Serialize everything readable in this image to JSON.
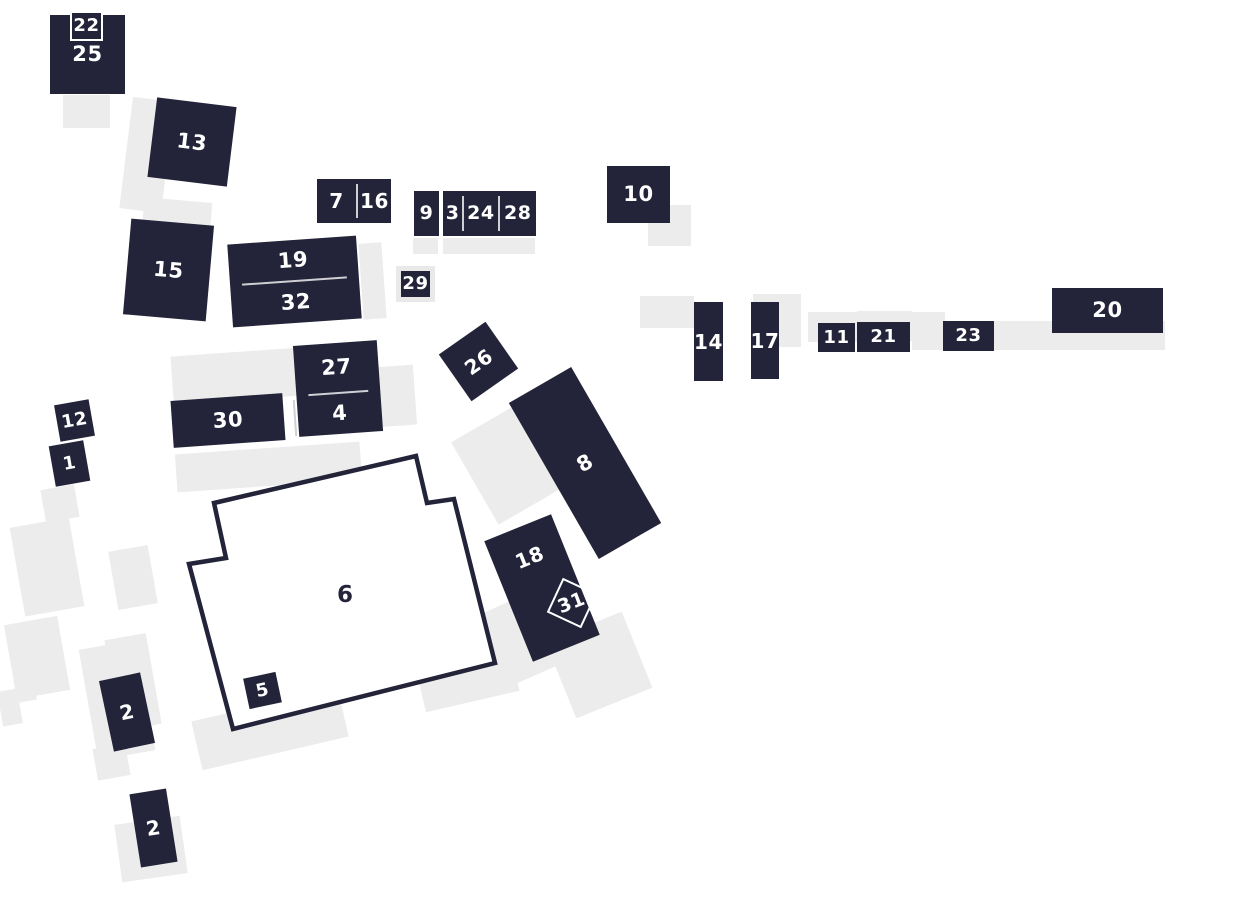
{
  "map": {
    "name": "numbered-building-site-map",
    "width": 1240,
    "height": 900
  },
  "colors": {
    "building": "#232339",
    "building_text": "#ffffff",
    "outline_text": "#232339",
    "shadow": "#ececec",
    "divider": "#cfcfd4",
    "frame": "#e9e9e9",
    "badge_border": "#ffffff",
    "background": "#ffffff"
  },
  "shadows": [
    {
      "x": 63,
      "y": 95,
      "w": 47,
      "h": 33,
      "rot": 0
    },
    {
      "x": 126,
      "y": 99,
      "w": 42,
      "h": 112,
      "rot": 7
    },
    {
      "x": 143,
      "y": 200,
      "w": 68,
      "h": 35,
      "rot": 5
    },
    {
      "x": 361,
      "y": 243,
      "w": 23,
      "h": 76,
      "rot": -4
    },
    {
      "x": 413,
      "y": 238,
      "w": 25,
      "h": 16,
      "rot": 0
    },
    {
      "x": 443,
      "y": 238,
      "w": 92,
      "h": 16,
      "rot": 0
    },
    {
      "x": 648,
      "y": 205,
      "w": 43,
      "h": 41,
      "rot": 0
    },
    {
      "x": 640,
      "y": 296,
      "w": 54,
      "h": 32,
      "rot": 0
    },
    {
      "x": 753,
      "y": 294,
      "w": 48,
      "h": 53,
      "rot": 0
    },
    {
      "x": 808,
      "y": 312,
      "w": 50,
      "h": 30,
      "rot": 0
    },
    {
      "x": 857,
      "y": 311,
      "w": 55,
      "h": 30,
      "rot": 0
    },
    {
      "x": 912,
      "y": 312,
      "w": 33,
      "h": 38,
      "rot": 0
    },
    {
      "x": 993,
      "y": 321,
      "w": 172,
      "h": 29,
      "rot": 0
    },
    {
      "x": 172,
      "y": 352,
      "w": 130,
      "h": 48,
      "rot": -4
    },
    {
      "x": 373,
      "y": 366,
      "w": 42,
      "h": 60,
      "rot": -4
    },
    {
      "x": 176,
      "y": 448,
      "w": 185,
      "h": 38,
      "rot": -4
    },
    {
      "x": 470,
      "y": 418,
      "w": 72,
      "h": 95,
      "rot": -30
    },
    {
      "x": 420,
      "y": 593,
      "w": 34,
      "h": 50,
      "rot": -22
    },
    {
      "x": 485,
      "y": 603,
      "w": 58,
      "h": 78,
      "rot": -24
    },
    {
      "x": 558,
      "y": 624,
      "w": 82,
      "h": 82,
      "rot": -22
    },
    {
      "x": 420,
      "y": 660,
      "w": 96,
      "h": 42,
      "rot": -13
    },
    {
      "x": 195,
      "y": 704,
      "w": 150,
      "h": 50,
      "rot": -13
    },
    {
      "x": 88,
      "y": 644,
      "w": 58,
      "h": 112,
      "rot": -10
    },
    {
      "x": 95,
      "y": 746,
      "w": 33,
      "h": 32,
      "rot": -10
    },
    {
      "x": 43,
      "y": 487,
      "w": 34,
      "h": 33,
      "rot": -10
    },
    {
      "x": 17,
      "y": 522,
      "w": 60,
      "h": 90,
      "rot": -10
    },
    {
      "x": 10,
      "y": 620,
      "w": 54,
      "h": 75,
      "rot": -10
    },
    {
      "x": 0,
      "y": 690,
      "w": 20,
      "h": 35,
      "rot": -10
    },
    {
      "x": 18,
      "y": 688,
      "w": 18,
      "h": 13,
      "rot": -10
    },
    {
      "x": 113,
      "y": 548,
      "w": 40,
      "h": 59,
      "rot": -10
    },
    {
      "x": 112,
      "y": 636,
      "w": 42,
      "h": 92,
      "rot": -10
    },
    {
      "x": 118,
      "y": 820,
      "w": 66,
      "h": 58,
      "rot": -8
    }
  ],
  "buildings": [
    {
      "id": "25",
      "kind": "block",
      "label": "25",
      "x": 50,
      "y": 15,
      "w": 75,
      "h": 79,
      "rot": 0,
      "fs": 21
    },
    {
      "id": "22",
      "kind": "badge",
      "label": "22",
      "x": 70,
      "y": 11,
      "w": 33,
      "h": 30,
      "rot": 0,
      "fs": 18
    },
    {
      "id": "13",
      "kind": "block",
      "label": "13",
      "x": 152,
      "y": 102,
      "w": 80,
      "h": 80,
      "rot": 7,
      "fs": 21
    },
    {
      "id": "15",
      "kind": "block",
      "label": "15",
      "x": 127,
      "y": 222,
      "w": 83,
      "h": 96,
      "rot": 5,
      "fs": 21
    },
    {
      "id": "19-32",
      "kind": "stack",
      "rows": [
        {
          "label": "19",
          "h": 41
        },
        {
          "label": "32",
          "h": 42
        }
      ],
      "x": 230,
      "y": 240,
      "w": 129,
      "h": 83,
      "rot": -4,
      "fs": 21
    },
    {
      "id": "7-16",
      "kind": "split",
      "cells": [
        {
          "label": "7",
          "w": 40
        },
        {
          "label": "16",
          "w": 34
        }
      ],
      "x": 317,
      "y": 179,
      "w": 74,
      "h": 44,
      "rot": 0,
      "fs": 20
    },
    {
      "id": "9",
      "kind": "block",
      "label": "9",
      "x": 414,
      "y": 191,
      "w": 25,
      "h": 45,
      "rot": 0,
      "fs": 19
    },
    {
      "id": "3-24-28",
      "kind": "split",
      "cells": [
        {
          "label": "3",
          "w": 20
        },
        {
          "label": "24",
          "w": 35
        },
        {
          "label": "28",
          "w": 38
        }
      ],
      "x": 443,
      "y": 191,
      "w": 93,
      "h": 45,
      "rot": 0,
      "fs": 19
    },
    {
      "id": "29",
      "kind": "frame",
      "label": "29",
      "x": 396,
      "y": 266,
      "w": 39,
      "h": 36,
      "rot": 0,
      "fs": 18
    },
    {
      "id": "10",
      "kind": "block",
      "label": "10",
      "x": 607,
      "y": 166,
      "w": 63,
      "h": 57,
      "rot": 0,
      "fs": 21
    },
    {
      "id": "14",
      "kind": "block",
      "label": "14",
      "x": 694,
      "y": 302,
      "w": 29,
      "h": 79,
      "rot": 0,
      "fs": 20
    },
    {
      "id": "17",
      "kind": "block",
      "label": "17",
      "x": 751,
      "y": 302,
      "w": 28,
      "h": 77,
      "rot": 0,
      "fs": 20
    },
    {
      "id": "11",
      "kind": "block",
      "label": "11",
      "x": 818,
      "y": 323,
      "w": 37,
      "h": 29,
      "rot": 0,
      "fs": 18
    },
    {
      "id": "21",
      "kind": "block",
      "label": "21",
      "x": 857,
      "y": 322,
      "w": 53,
      "h": 30,
      "rot": 0,
      "fs": 18
    },
    {
      "id": "23",
      "kind": "block",
      "label": "23",
      "x": 943,
      "y": 321,
      "w": 51,
      "h": 30,
      "rot": 0,
      "fs": 18
    },
    {
      "id": "20",
      "kind": "block",
      "label": "20",
      "x": 1052,
      "y": 288,
      "w": 111,
      "h": 45,
      "rot": 0,
      "fs": 21
    },
    {
      "id": "26",
      "kind": "block",
      "label": "26",
      "x": 450,
      "y": 333,
      "w": 57,
      "h": 57,
      "rot": -35,
      "fs": 20
    },
    {
      "id": "8",
      "kind": "block",
      "label": "8",
      "x": 549,
      "y": 373,
      "w": 72,
      "h": 180,
      "rot": -30,
      "fs": 21
    },
    {
      "id": "27-4",
      "kind": "stack",
      "rows": [
        {
          "label": "27",
          "h": 50
        },
        {
          "label": "4",
          "h": 41
        }
      ],
      "x": 296,
      "y": 343,
      "w": 84,
      "h": 91,
      "rot": -4,
      "fs": 21
    },
    {
      "id": "30",
      "kind": "block",
      "label": "30",
      "x": 172,
      "y": 397,
      "w": 112,
      "h": 47,
      "rot": -4,
      "fs": 21
    },
    {
      "id": "30-4-divider",
      "kind": "line",
      "x": 294,
      "y": 400,
      "w": 2,
      "h": 36,
      "rot": -4
    },
    {
      "id": "12",
      "kind": "block",
      "label": "12",
      "x": 57,
      "y": 402,
      "w": 35,
      "h": 37,
      "rot": -10,
      "fs": 18
    },
    {
      "id": "1",
      "kind": "block",
      "label": "1",
      "x": 52,
      "y": 443,
      "w": 35,
      "h": 41,
      "rot": -10,
      "fs": 18
    },
    {
      "id": "6",
      "kind": "polygon",
      "label": "6",
      "ox": 170,
      "oy": 450,
      "sw": 340,
      "sh": 290,
      "points": "44,53 246,6 257,53 284,49 325,213 63,279 19,114 56,108",
      "label_x": 175,
      "label_y": 152,
      "fs": 23,
      "stroke_w": 4.5
    },
    {
      "id": "5",
      "kind": "block",
      "label": "5",
      "x": 246,
      "y": 675,
      "w": 33,
      "h": 31,
      "rot": -12,
      "fs": 18
    },
    {
      "id": "18",
      "kind": "block",
      "label": "18",
      "x": 506,
      "y": 523,
      "w": 72,
      "h": 130,
      "rot": -22,
      "fs": 20,
      "label_dy": -33
    },
    {
      "id": "31",
      "kind": "diamond",
      "label": "31",
      "x": 553,
      "y": 584,
      "w": 38,
      "h": 38,
      "rot": 25,
      "text_rot": -46,
      "fs": 19
    },
    {
      "id": "2a",
      "kind": "block",
      "label": "2",
      "x": 106,
      "y": 676,
      "w": 42,
      "h": 72,
      "rot": -12,
      "fs": 20
    },
    {
      "id": "2b",
      "kind": "block",
      "label": "2",
      "x": 135,
      "y": 791,
      "w": 37,
      "h": 74,
      "rot": -9,
      "fs": 20
    }
  ]
}
